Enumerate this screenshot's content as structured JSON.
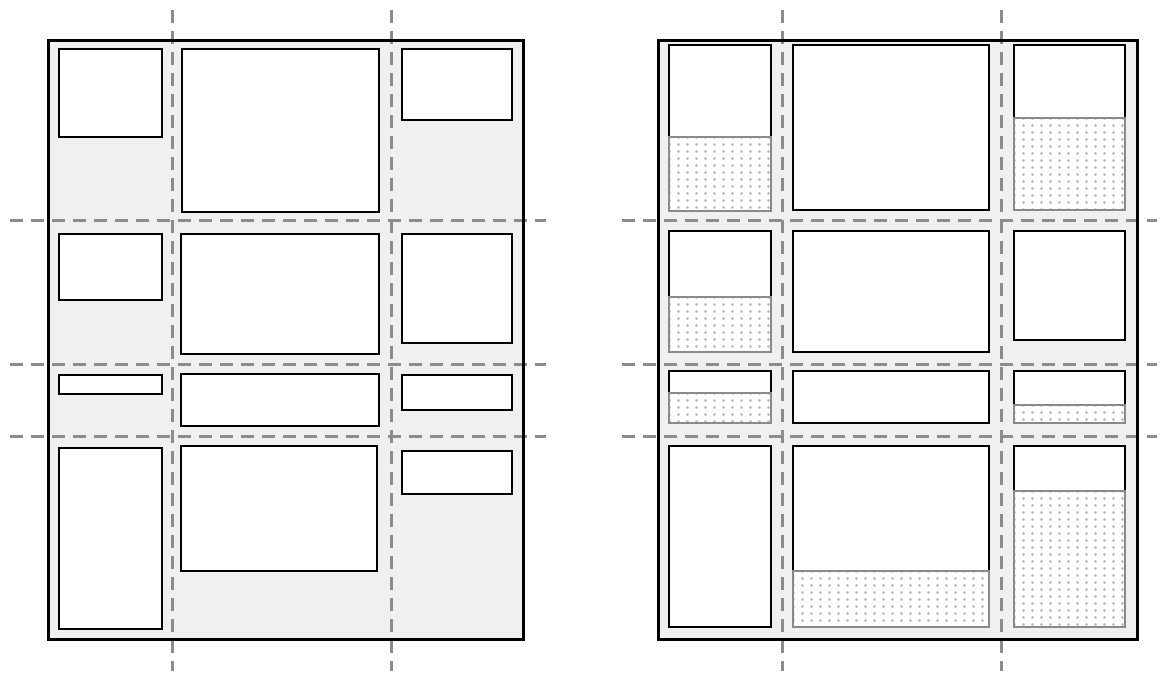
{
  "diagram": {
    "width": 1171,
    "height": 679,
    "colors": {
      "page_bg": "#ffffff",
      "container_bg": "#f0f0f0",
      "container_border": "#000000",
      "item_bg": "#ffffff",
      "item_border": "#000000",
      "gridline": "#8c8c8c",
      "extra_border": "#8a8a8a",
      "extra_bg": "#ffffff",
      "extra_dot": "#b4b4b4"
    },
    "line_style": {
      "dash_length": 13,
      "dash_period": 21,
      "gridline_thickness": 3,
      "container_border_thickness": 3,
      "item_border_thickness": 2.5,
      "extra_border_thickness": 2.5
    },
    "figures": [
      {
        "name": "grid-with-content-sized-items",
        "container": {
          "x": 47,
          "y": 39,
          "w": 478,
          "h": 602
        },
        "v_gridlines": {
          "xs": [
            172,
            391
          ],
          "y1": 10,
          "y2": 671
        },
        "h_gridlines": {
          "ys": [
            220,
            364,
            436
          ],
          "x1": 10,
          "x2": 546
        },
        "items": [
          {
            "row": 1,
            "col": 1,
            "x": 58,
            "y": 48,
            "w": 105,
            "content_h": 90,
            "extra_h": 0
          },
          {
            "row": 1,
            "col": 2,
            "x": 181,
            "y": 48,
            "w": 199,
            "content_h": 165,
            "extra_h": 0
          },
          {
            "row": 1,
            "col": 3,
            "x": 401,
            "y": 48,
            "w": 112,
            "content_h": 73,
            "extra_h": 0
          },
          {
            "row": 2,
            "col": 1,
            "x": 58,
            "y": 233,
            "w": 105,
            "content_h": 68,
            "extra_h": 0
          },
          {
            "row": 2,
            "col": 2,
            "x": 180,
            "y": 233,
            "w": 200,
            "content_h": 122,
            "extra_h": 0
          },
          {
            "row": 2,
            "col": 3,
            "x": 401,
            "y": 233,
            "w": 112,
            "content_h": 111,
            "extra_h": 0
          },
          {
            "row": 3,
            "col": 1,
            "x": 58,
            "y": 374,
            "w": 105,
            "content_h": 21,
            "extra_h": 0
          },
          {
            "row": 3,
            "col": 2,
            "x": 180,
            "y": 373,
            "w": 200,
            "content_h": 54,
            "extra_h": 0
          },
          {
            "row": 3,
            "col": 3,
            "x": 401,
            "y": 374,
            "w": 112,
            "content_h": 37,
            "extra_h": 0
          },
          {
            "row": 4,
            "col": 1,
            "x": 58,
            "y": 447,
            "w": 105,
            "content_h": 183,
            "extra_h": 0
          },
          {
            "row": 4,
            "col": 2,
            "x": 180,
            "y": 445,
            "w": 198,
            "content_h": 127,
            "extra_h": 0
          },
          {
            "row": 4,
            "col": 3,
            "x": 401,
            "y": 450,
            "w": 112,
            "content_h": 45,
            "extra_h": 0
          }
        ]
      },
      {
        "name": "grid-with-stretched-cells-dotted-extra-space",
        "container": {
          "x": 657,
          "y": 39,
          "w": 482,
          "h": 602
        },
        "v_gridlines": {
          "xs": [
            782,
            1001
          ],
          "y1": 10,
          "y2": 671
        },
        "h_gridlines": {
          "ys": [
            220,
            364,
            436
          ],
          "x1": 622,
          "x2": 1157
        },
        "items": [
          {
            "row": 1,
            "col": 1,
            "x": 668,
            "y": 44,
            "w": 104,
            "content_h": 92,
            "extra_h": 76
          },
          {
            "row": 1,
            "col": 2,
            "x": 792,
            "y": 44,
            "w": 198,
            "content_h": 167,
            "extra_h": 0
          },
          {
            "row": 1,
            "col": 3,
            "x": 1013,
            "y": 44,
            "w": 113,
            "content_h": 73,
            "extra_h": 94
          },
          {
            "row": 2,
            "col": 1,
            "x": 668,
            "y": 230,
            "w": 104,
            "content_h": 66,
            "extra_h": 57
          },
          {
            "row": 2,
            "col": 2,
            "x": 792,
            "y": 230,
            "w": 198,
            "content_h": 123,
            "extra_h": 0
          },
          {
            "row": 2,
            "col": 3,
            "x": 1013,
            "y": 230,
            "w": 113,
            "content_h": 111,
            "extra_h": 0
          },
          {
            "row": 3,
            "col": 1,
            "x": 668,
            "y": 370,
            "w": 104,
            "content_h": 22,
            "extra_h": 32
          },
          {
            "row": 3,
            "col": 2,
            "x": 792,
            "y": 370,
            "w": 198,
            "content_h": 54,
            "extra_h": 0
          },
          {
            "row": 3,
            "col": 3,
            "x": 1013,
            "y": 370,
            "w": 113,
            "content_h": 34,
            "extra_h": 20
          },
          {
            "row": 4,
            "col": 1,
            "x": 668,
            "y": 445,
            "w": 104,
            "content_h": 183,
            "extra_h": 0
          },
          {
            "row": 4,
            "col": 2,
            "x": 792,
            "y": 445,
            "w": 198,
            "content_h": 125,
            "extra_h": 58
          },
          {
            "row": 4,
            "col": 3,
            "x": 1013,
            "y": 445,
            "w": 113,
            "content_h": 45,
            "extra_h": 138
          }
        ]
      }
    ]
  }
}
